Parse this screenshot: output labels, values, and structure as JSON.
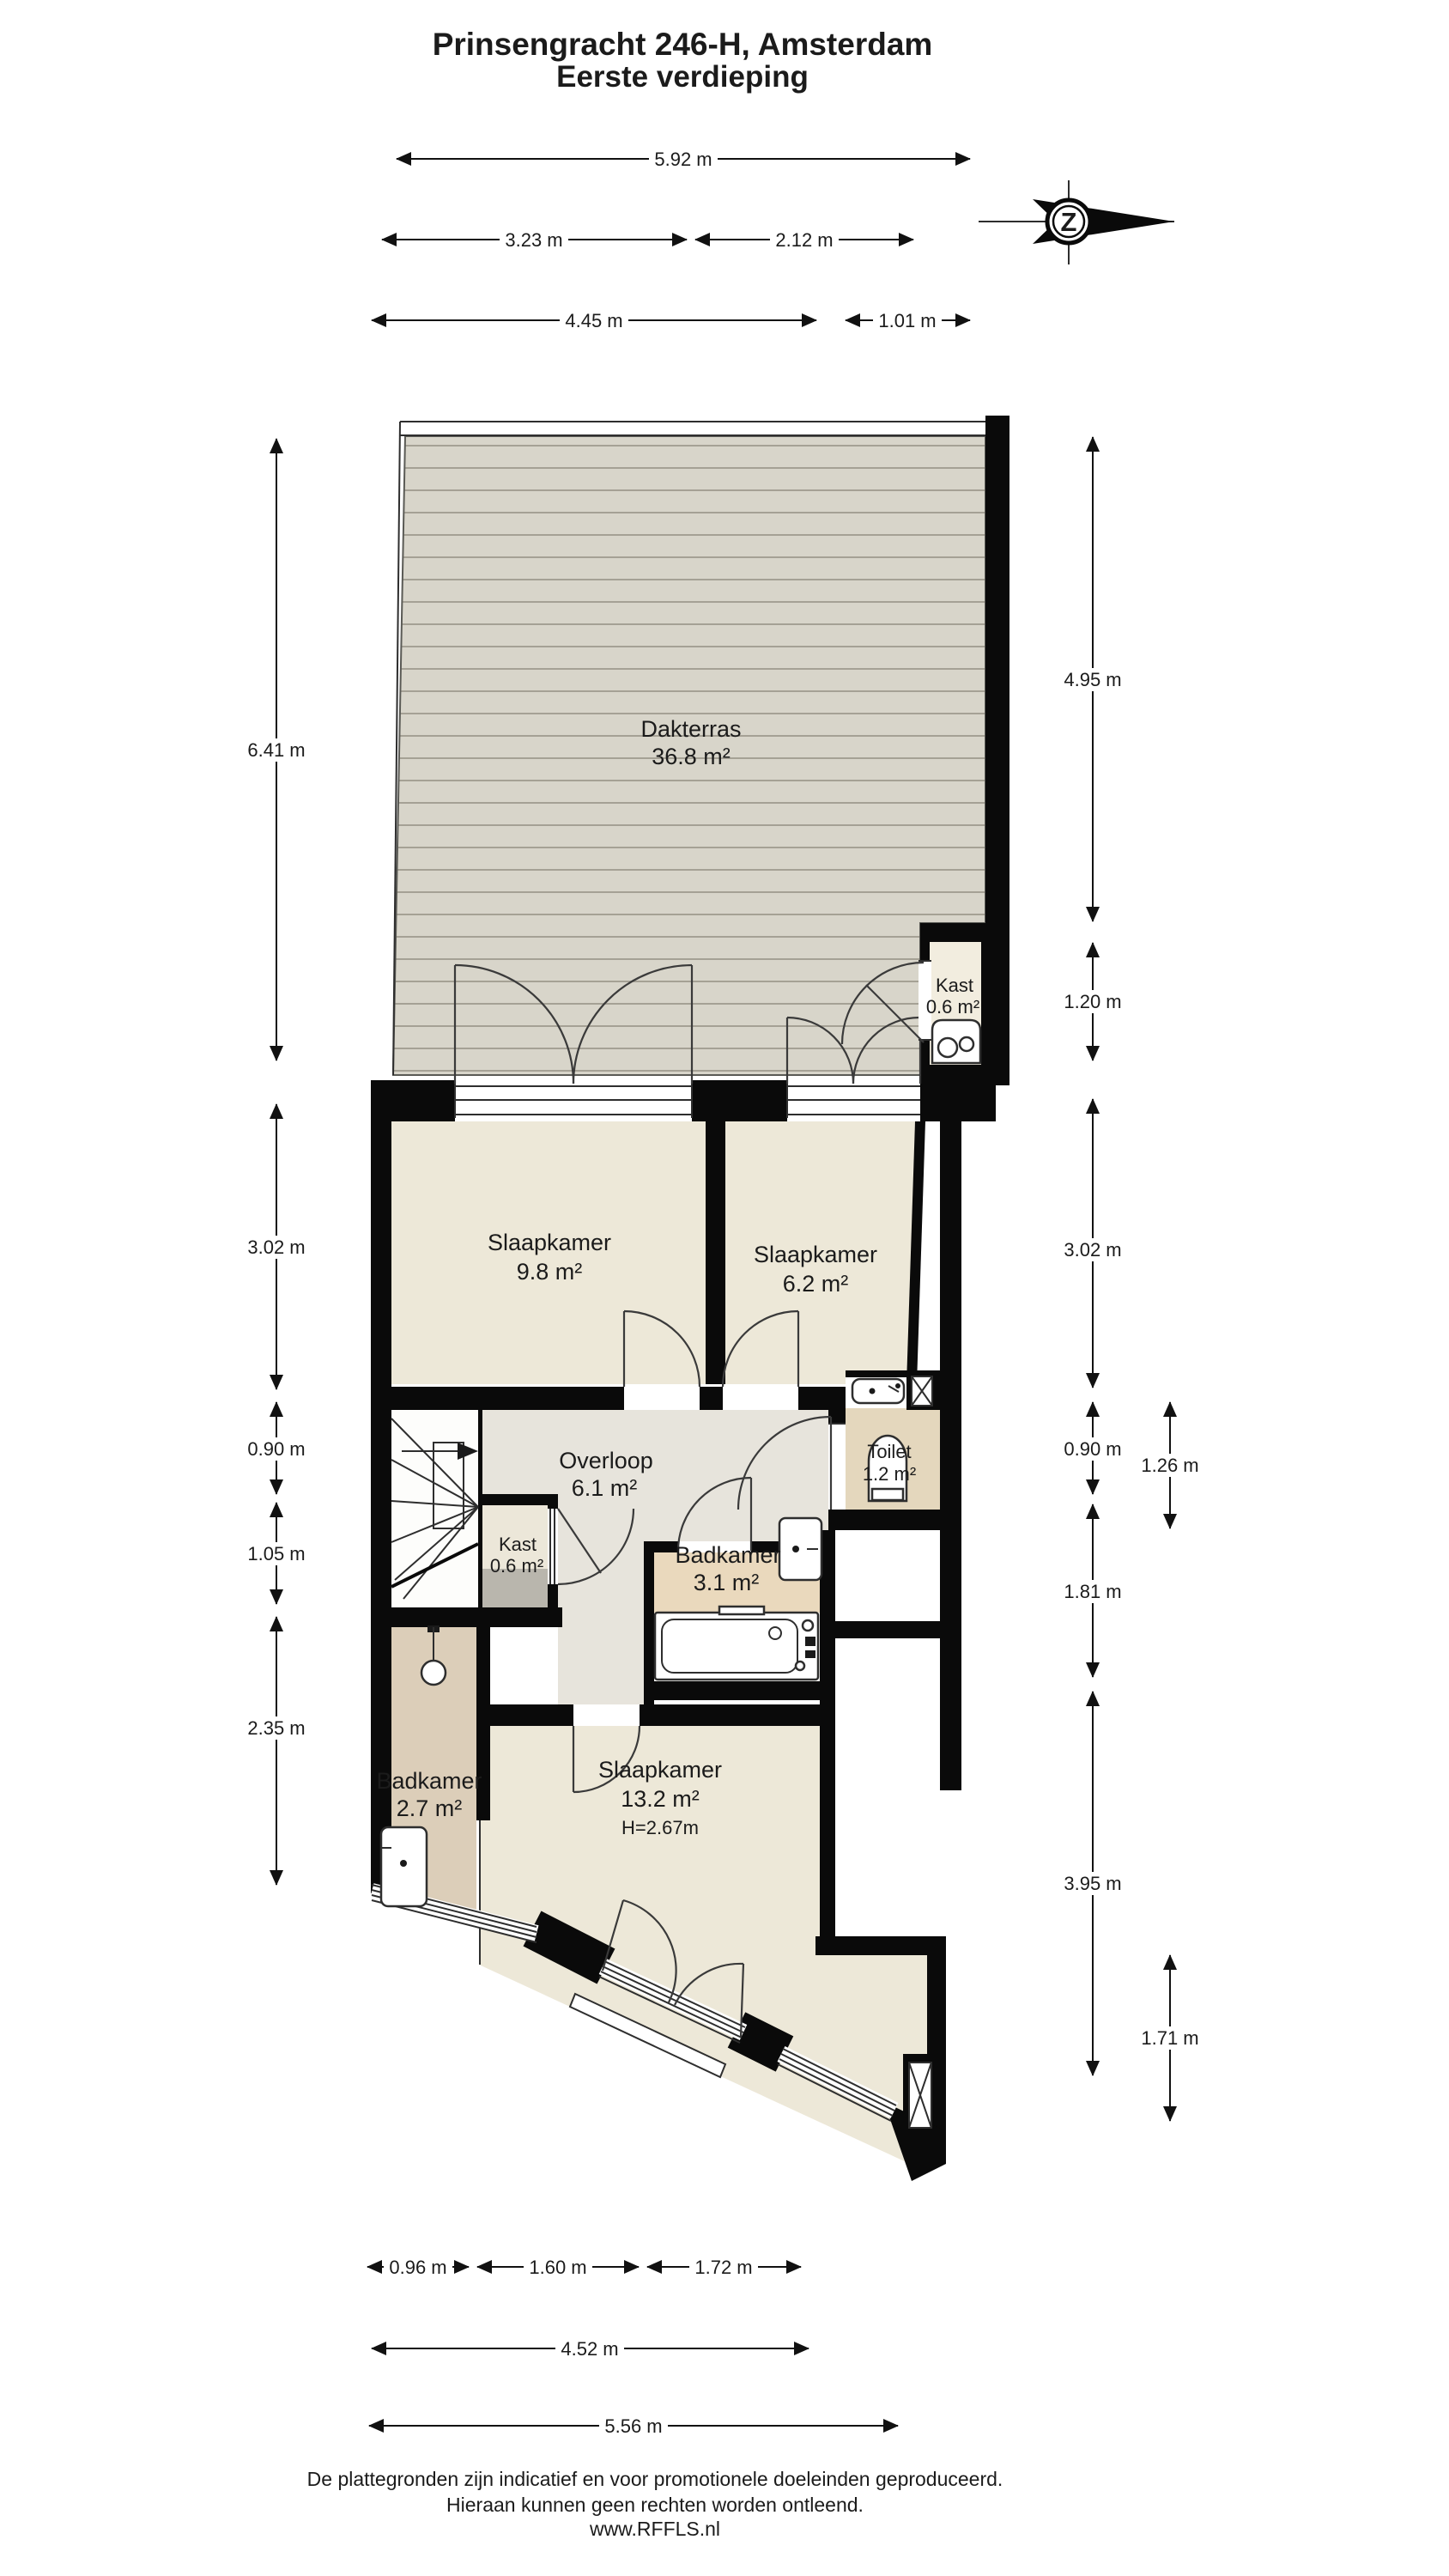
{
  "title": {
    "line1": "Prinsengracht 246-H, Amsterdam",
    "line2": "Eerste verdieping"
  },
  "compass": {
    "letter": "Z"
  },
  "rooms": {
    "dakterras": {
      "name": "Dakterras",
      "area": "36.8 m²"
    },
    "kast_terras": {
      "name": "Kast",
      "area": "0.6 m²"
    },
    "slaapkamer_1": {
      "name": "Slaapkamer",
      "area": "9.8 m²"
    },
    "slaapkamer_2": {
      "name": "Slaapkamer",
      "area": "6.2 m²"
    },
    "overloop": {
      "name": "Overloop",
      "area": "6.1 m²"
    },
    "toilet": {
      "name": "Toilet",
      "area": "1.2 m²"
    },
    "kast_hal": {
      "name": "Kast",
      "area": "0.6 m²"
    },
    "badkamer_boven": {
      "name": "Badkamer",
      "area": "3.1 m²"
    },
    "badkamer_onder": {
      "name": "Badkamer",
      "area": "2.7 m²"
    },
    "slaapkamer_3": {
      "name": "Slaapkamer",
      "area": "13.2 m²",
      "height": "H=2.67m"
    }
  },
  "dimensions": {
    "top": [
      {
        "label": "5.92 m"
      },
      {
        "label": "3.23 m"
      },
      {
        "label": "2.12 m"
      },
      {
        "label": "4.45 m"
      },
      {
        "label": "1.01 m"
      }
    ],
    "left": [
      {
        "label": "6.41 m"
      },
      {
        "label": "3.02 m"
      },
      {
        "label": "0.90 m"
      },
      {
        "label": "1.05 m"
      },
      {
        "label": "2.35 m"
      }
    ],
    "right": [
      {
        "label": "4.95 m"
      },
      {
        "label": "1.20 m"
      },
      {
        "label": "3.02 m"
      },
      {
        "label": "0.90 m"
      },
      {
        "label": "1.26 m"
      },
      {
        "label": "1.81 m"
      },
      {
        "label": "3.95 m"
      },
      {
        "label": "1.71 m"
      }
    ],
    "bottom": [
      {
        "label": "0.96 m"
      },
      {
        "label": "1.60 m"
      },
      {
        "label": "1.72 m"
      },
      {
        "label": "4.52 m"
      },
      {
        "label": "5.56 m"
      }
    ]
  },
  "footer": {
    "line1": "De plattegronden zijn indicatief en voor promotionele doeleinden geproduceerd.",
    "line2": "Hieraan kunnen geen rechten worden ontleend.",
    "line3": "www.RFFLS.nl"
  },
  "colors": {
    "wall": "#0a0a0a",
    "terrace_deck": "#d8d5ca",
    "deck_line": "#a5a195",
    "room_cream": "#ede8d8",
    "hall_grey": "#e7e4dc",
    "bath_tan": "#ead9bd",
    "toilet_tan": "#e4d7bd",
    "bath2_tan": "#dcceb9",
    "shelf_grey": "#b9b6ad"
  }
}
